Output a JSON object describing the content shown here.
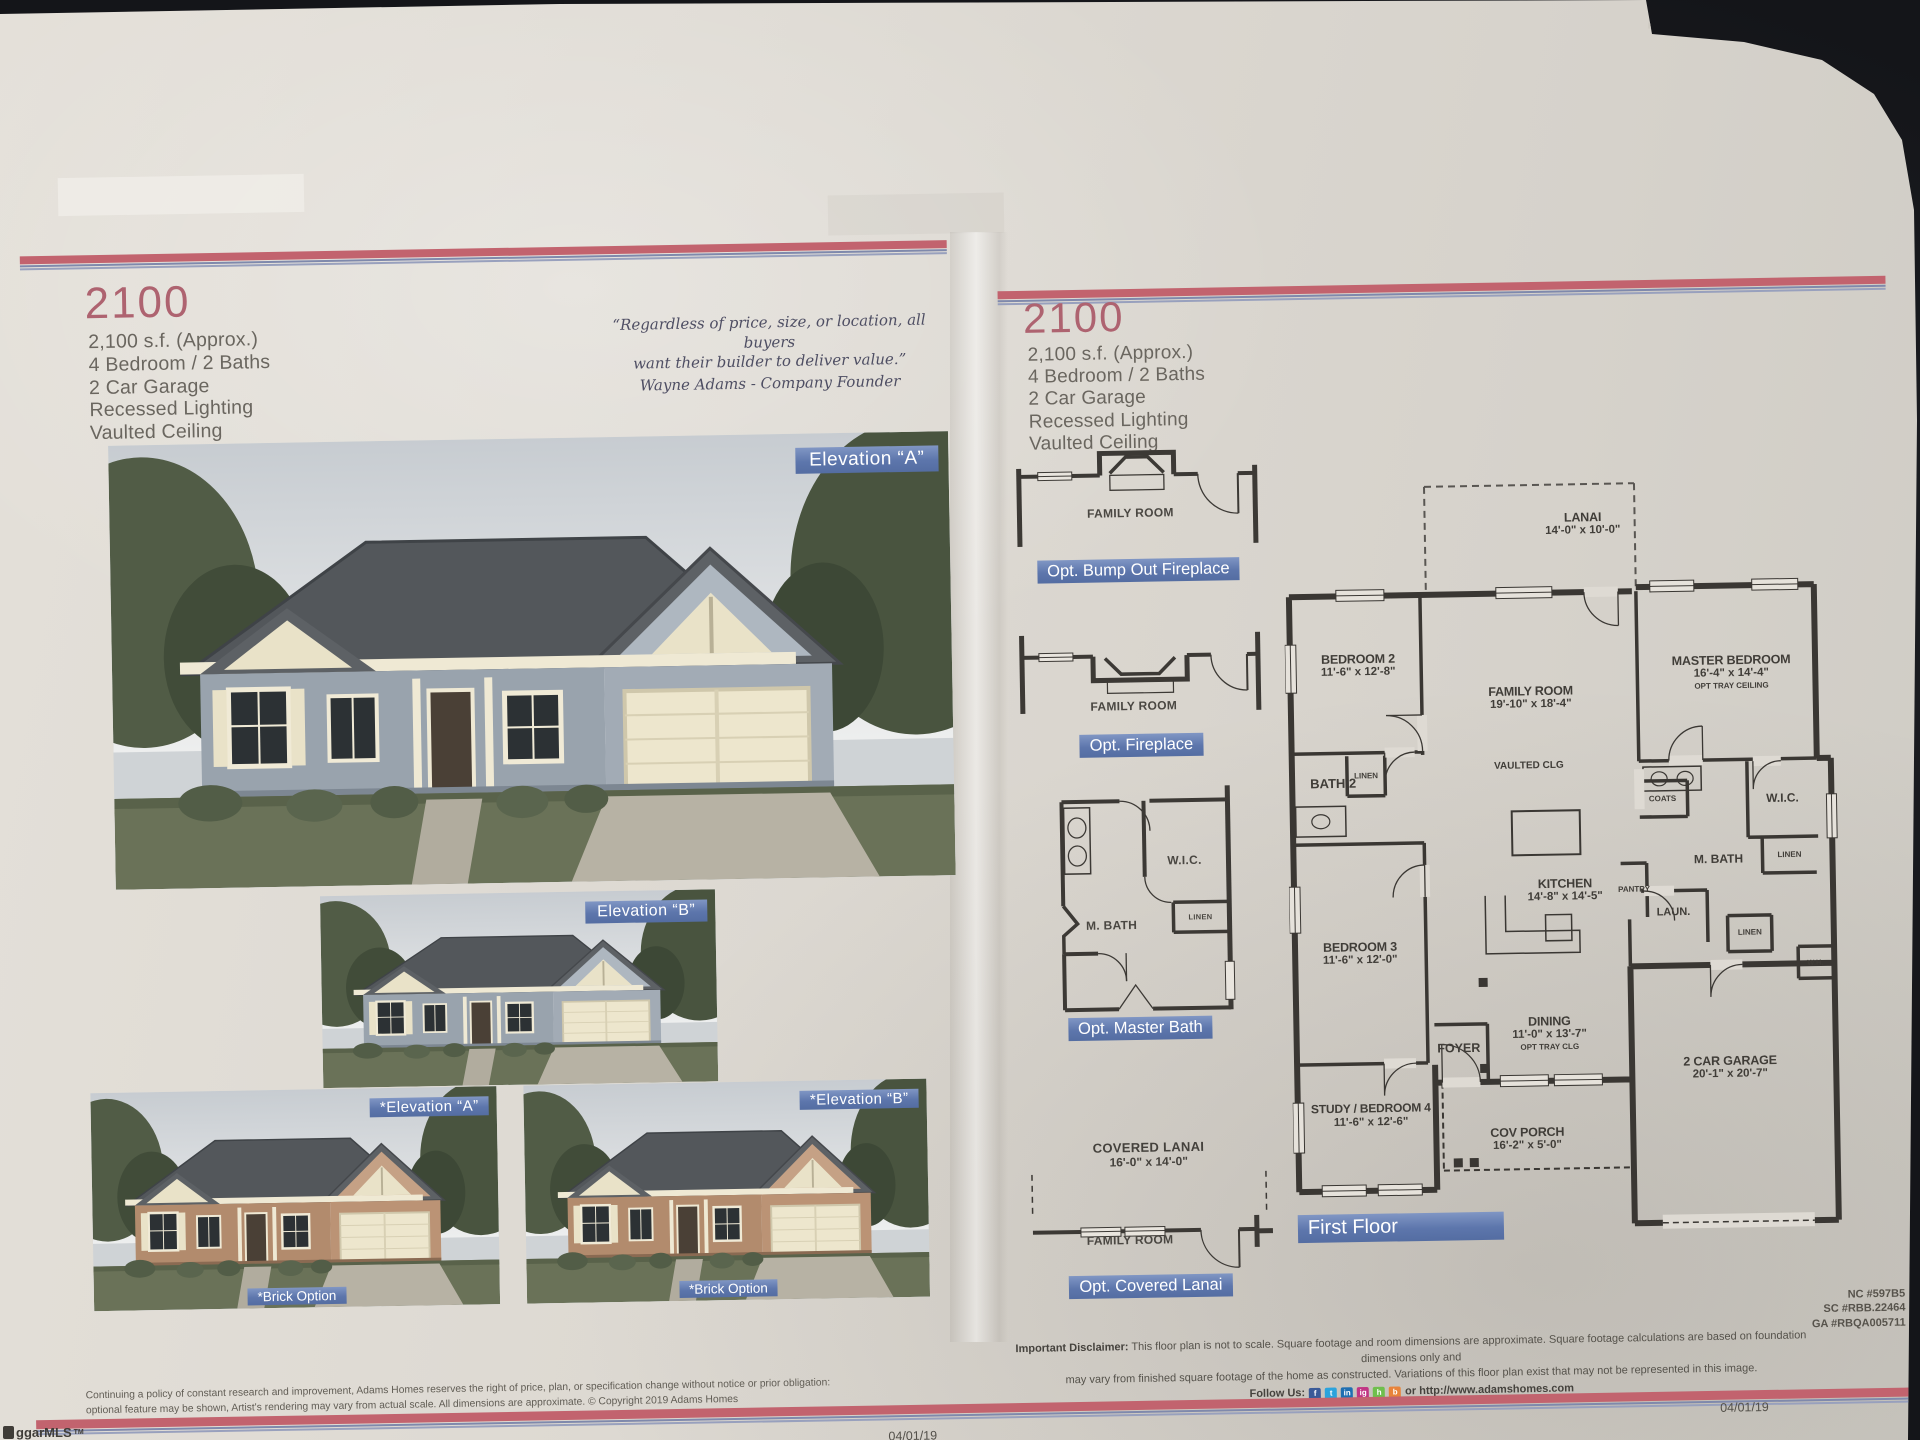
{
  "photo": {
    "watermark": "ggarMLS",
    "watermark_tm": "TM",
    "date_left": "04/01/19",
    "date_right": "04/01/19"
  },
  "left_page": {
    "model": "2100",
    "specs": [
      "2,100 s.f. (Approx.)",
      "4 Bedroom / 2 Baths",
      "2 Car Garage",
      "Recessed Lighting",
      "Vaulted Ceiling"
    ],
    "quote": {
      "line1": "“Regardless of price, size, or location, all buyers",
      "line2": "want their builder to deliver value.”",
      "attribution": "Wayne Adams - Company Founder"
    },
    "elevation_a_label": "Elevation “A”",
    "elevation_b_label": "Elevation “B”",
    "brick_a_label": "*Elevation “A”",
    "brick_b_label": "*Elevation “B”",
    "brick_option_label": "*Brick Option",
    "fine_print_line1": "Continuing a policy of constant research and improvement, Adams Homes reserves the right of price, plan, or specification change without notice or prior obligation:",
    "fine_print_line2": "optional feature may be shown, Artist's rendering may vary from actual scale. All dimensions are approximate. © Copyright 2019 Adams Homes"
  },
  "right_page": {
    "model": "2100",
    "specs": [
      "2,100 s.f. (Approx.)",
      "4 Bedroom / 2 Baths",
      "2 Car Garage",
      "Recessed Lighting",
      "Vaulted Ceiling"
    ],
    "options": {
      "bump_out": {
        "room": "FAMILY ROOM",
        "banner": "Opt. Bump Out Fireplace"
      },
      "fireplace": {
        "room": "FAMILY ROOM",
        "banner": "Opt. Fireplace"
      },
      "master_bath": {
        "wic": "W.I.C.",
        "mbath": "M. BATH",
        "linen": "LINEN",
        "banner": "Opt. Master Bath"
      },
      "covered_lanai": {
        "area": "COVERED LANAI",
        "dims": "16'-0\" x 14'-0\"",
        "room": "FAMILY ROOM",
        "banner": "Opt. Covered Lanai"
      }
    },
    "floor_plan": {
      "banner": "First Floor",
      "rooms": {
        "lanai": {
          "name": "LANAI",
          "dims": "14'-0\" x 10'-0\""
        },
        "bedroom2": {
          "name": "BEDROOM 2",
          "dims": "11'-6\" x 12'-8\""
        },
        "family": {
          "name": "FAMILY ROOM",
          "dims": "19'-10\" x 18'-4\""
        },
        "master": {
          "name": "MASTER BEDROOM",
          "dims": "16'-4\" x 14'-4\"",
          "note": "OPT TRAY CEILING"
        },
        "vaulted": {
          "name": "VAULTED CLG"
        },
        "bath2": {
          "name": "BATH 2"
        },
        "linen_bath2": {
          "name": "LINEN"
        },
        "coats": {
          "name": "COATS"
        },
        "wic": {
          "name": "W.I.C."
        },
        "kitchen": {
          "name": "KITCHEN",
          "dims": "14'-8\" x 14'-5\""
        },
        "mbath": {
          "name": "M. BATH"
        },
        "linen_mbath": {
          "name": "LINEN"
        },
        "pantry": {
          "name": "PANTRY"
        },
        "laundry": {
          "name": "LAUN."
        },
        "linen_hall": {
          "name": "LINEN"
        },
        "bedroom3": {
          "name": "BEDROOM 3",
          "dims": "11'-6\" x 12'-0\""
        },
        "water_heater": {
          "name": "W.H."
        },
        "dining": {
          "name": "DINING",
          "dims": "11'-0\" x 13'-7\"",
          "note": "OPT TRAY CLG"
        },
        "foyer": {
          "name": "FOYER"
        },
        "garage": {
          "name": "2 CAR GARAGE",
          "dims": "20'-1\" x 20'-7\""
        },
        "study": {
          "name": "STUDY / BEDROOM 4",
          "dims": "11'-6\" x 12'-6\""
        },
        "porch": {
          "name": "COV PORCH",
          "dims": "16'-2\" x 5'-0\""
        }
      }
    },
    "registrations": [
      "NC #597B5",
      "SC #RBB.22464",
      "GA #RBQA005711"
    ],
    "disclaimer": {
      "label": "Important Disclaimer:",
      "line1": " This floor plan is not to scale. Square footage and room dimensions are approximate. Square footage calculations are based on foundation dimensions only and",
      "line2": "may vary from finished square footage of the home as constructed. Variations of this floor plan exist that may not be represented in this image.",
      "follow": "Follow Us:",
      "url": "or http://www.adamshomes.com"
    }
  },
  "colors": {
    "banner_blue": "#5d76ac",
    "rule_red": "#c2636e",
    "rule_blue": "#7f89ac",
    "title_pink": "#ae6370"
  }
}
